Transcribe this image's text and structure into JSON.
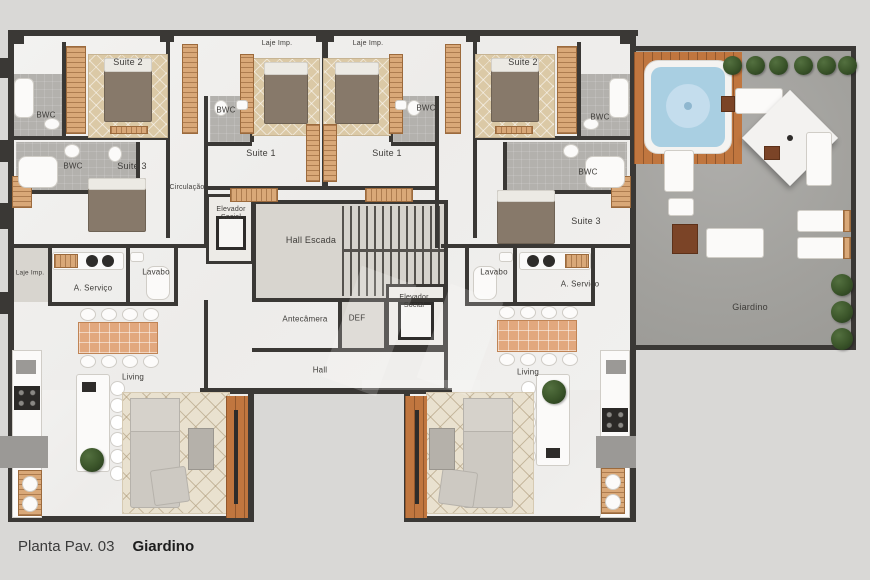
{
  "caption": {
    "prefix": "Planta Pav. 03",
    "title": "Giardino"
  },
  "palette": {
    "wall": "#3a3835",
    "floor": "#f1f0ed",
    "bath": "#b3b1ad",
    "wood": "#d9a878",
    "deck": "#c0763f",
    "water": "#a9cfe2",
    "concrete": "#a7a6a2",
    "bush": "#2e4527",
    "background": "#d9d8d6",
    "text": "#3e3c39"
  },
  "labels": [
    {
      "id": "suite2-left",
      "text": "Suite 2",
      "x": 128,
      "y": 62,
      "s": 9
    },
    {
      "id": "bwc-left-top",
      "text": "BWC",
      "x": 46,
      "y": 115,
      "s": 8
    },
    {
      "id": "bwc-left-2",
      "text": "BWC",
      "x": 73,
      "y": 166,
      "s": 8
    },
    {
      "id": "suite3-left",
      "text": "Suite 3",
      "x": 132,
      "y": 166,
      "s": 9
    },
    {
      "id": "circulacao",
      "text": "Circulação",
      "x": 187,
      "y": 188,
      "s": 7
    },
    {
      "id": "laje-top-left",
      "text": "Laje Imp.",
      "x": 277,
      "y": 44,
      "s": 7
    },
    {
      "id": "laje-top-right",
      "text": "Laje Imp.",
      "x": 368,
      "y": 44,
      "s": 7
    },
    {
      "id": "suite1-left",
      "text": "Suite 1",
      "x": 261,
      "y": 153,
      "s": 9
    },
    {
      "id": "suite1-right",
      "text": "Suite 1",
      "x": 387,
      "y": 153,
      "s": 9
    },
    {
      "id": "bwc-mid-left",
      "text": "BWC",
      "x": 226,
      "y": 110,
      "s": 8
    },
    {
      "id": "bwc-mid-right",
      "text": "BWC",
      "x": 426,
      "y": 108,
      "s": 8
    },
    {
      "id": "suite2-right",
      "text": "Suite 2",
      "x": 523,
      "y": 62,
      "s": 9
    },
    {
      "id": "bwc-right-top",
      "text": "BWC",
      "x": 600,
      "y": 117,
      "s": 8
    },
    {
      "id": "bwc-right-2",
      "text": "BWC",
      "x": 588,
      "y": 172,
      "s": 8
    },
    {
      "id": "suite3-right",
      "text": "Suite 3",
      "x": 586,
      "y": 221,
      "s": 9
    },
    {
      "id": "elevador-left",
      "text": "Elevador\nSocial",
      "x": 231,
      "y": 214,
      "s": 7
    },
    {
      "id": "hall-escada",
      "text": "Hall Escada",
      "x": 311,
      "y": 240,
      "s": 9
    },
    {
      "id": "antecamera",
      "text": "Antecâmera",
      "x": 305,
      "y": 319,
      "s": 8
    },
    {
      "id": "def",
      "text": "DEF",
      "x": 357,
      "y": 318,
      "s": 8
    },
    {
      "id": "elevador-right",
      "text": "Elevador\nSocial",
      "x": 414,
      "y": 302,
      "s": 7
    },
    {
      "id": "hall",
      "text": "Hall",
      "x": 320,
      "y": 370,
      "s": 8
    },
    {
      "id": "laje-far-left",
      "text": "Laje Imp.",
      "x": 30,
      "y": 273,
      "s": 6.5
    },
    {
      "id": "servico-left",
      "text": "A. Serviço",
      "x": 93,
      "y": 288,
      "s": 8
    },
    {
      "id": "lavabo-left",
      "text": "Lavabo",
      "x": 156,
      "y": 272,
      "s": 8
    },
    {
      "id": "lavabo-right",
      "text": "Lavabo",
      "x": 494,
      "y": 272,
      "s": 8
    },
    {
      "id": "servico-right",
      "text": "A. Serviço",
      "x": 580,
      "y": 284,
      "s": 8
    },
    {
      "id": "living-left",
      "text": "Living",
      "x": 133,
      "y": 377,
      "s": 8
    },
    {
      "id": "living-right",
      "text": "Living",
      "x": 528,
      "y": 372,
      "s": 8
    },
    {
      "id": "giardino",
      "text": "Giardino",
      "x": 750,
      "y": 307,
      "s": 9
    }
  ]
}
